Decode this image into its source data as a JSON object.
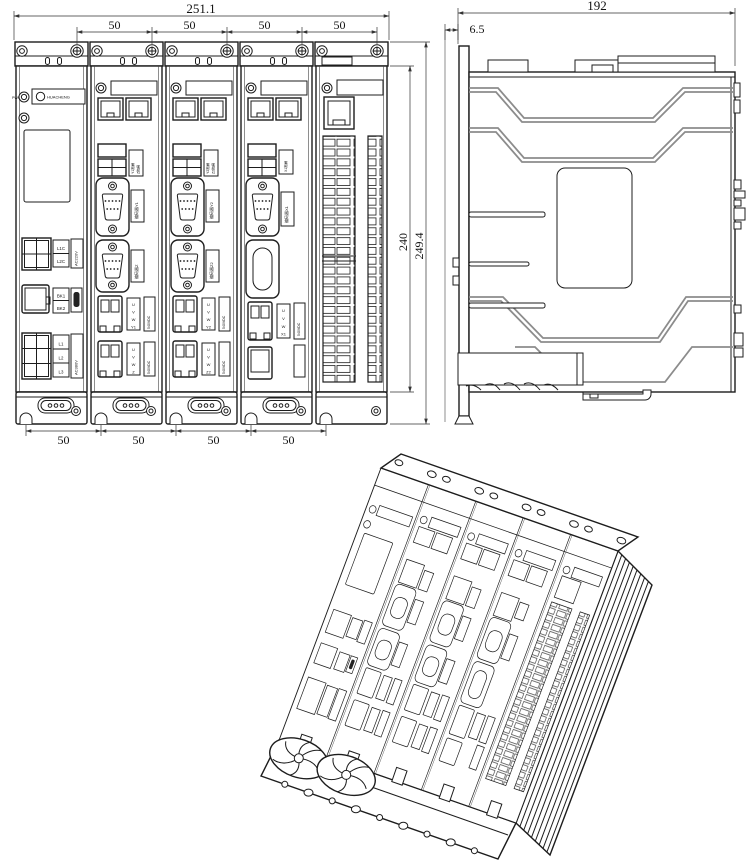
{
  "front_view": {
    "dims": {
      "total_width": "251.1",
      "top_pitches": [
        "50",
        "50",
        "50",
        "50"
      ],
      "bottom_pitches": [
        "50",
        "50",
        "50",
        "50"
      ],
      "body_height": "240",
      "overall_height": "249.4"
    },
    "power_module": {
      "led1": "PWR",
      "brand": "HUACHENG",
      "control_terminals": [
        "L1C",
        "L2C"
      ],
      "control_note": "AC220V",
      "brake_terminals": [
        "BK1",
        "BK2"
      ],
      "main_terminals": [
        "L1",
        "L2",
        "L3"
      ],
      "main_note": "AC380V"
    },
    "axis_module_2": {
      "brake_labels": [
        "Y1抱闸",
        "Z抱闸"
      ],
      "encoder_top": "编码器Y1",
      "encoder_bottom": "编码器Z",
      "motor_top": [
        "U",
        "V",
        "W",
        "Y1"
      ],
      "motor_bottom": [
        "U",
        "V",
        "W",
        "Z"
      ],
      "bus_note": "540VDC"
    },
    "axis_module_3": {
      "brake_labels": [
        "Y2抱闸",
        "Z2抱闸"
      ],
      "encoder_top": "编码器Y2",
      "encoder_bottom": "编码器Z2",
      "motor_top": [
        "U",
        "V",
        "W",
        "Y2"
      ],
      "motor_bottom": [
        "U",
        "V",
        "W",
        "Z2"
      ],
      "bus_note": "540VDC"
    },
    "axis_module_4": {
      "brake_label": "X1抱闸",
      "encoder_top": "编码器X1",
      "motor_top": [
        "U",
        "V",
        "W",
        "X1"
      ],
      "bus_note": "540VDC"
    }
  },
  "side_view": {
    "dims": {
      "depth": "192",
      "front_offset": "6.5"
    }
  }
}
